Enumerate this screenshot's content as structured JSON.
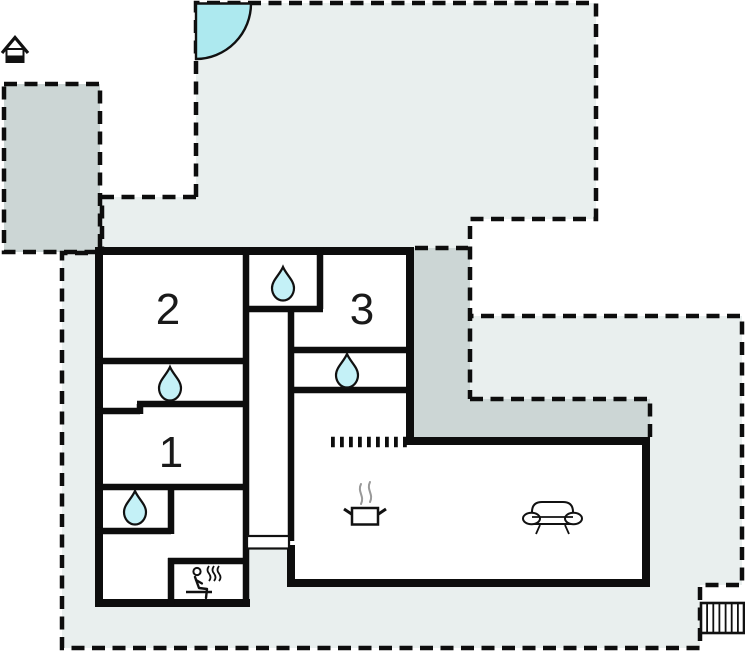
{
  "plan": {
    "type": "holiday-home-floor-plan",
    "rooms": [
      {
        "id": "room-2",
        "label": "2"
      },
      {
        "id": "room-3",
        "label": "3"
      },
      {
        "id": "room-1",
        "label": "1"
      }
    ],
    "icons": [
      {
        "name": "house-icon",
        "meaning": "house / orientation marker"
      },
      {
        "name": "door-swing-icon",
        "meaning": "quarter-circle swing at plot entrance"
      },
      {
        "name": "water-drop-icon",
        "meaning": "water / bathroom",
        "count": 4
      },
      {
        "name": "sauna-icon",
        "meaning": "sauna"
      },
      {
        "name": "stove-icon",
        "meaning": "kitchen stove"
      },
      {
        "name": "sofa-icon",
        "meaning": "living room sofa"
      },
      {
        "name": "steps-grate-icon",
        "meaning": "outdoor steps / grate"
      }
    ],
    "colors": {
      "plot": "#e9efee",
      "terrace": "#ccd6d5",
      "water": "#c4f1f7",
      "pool": "#ade9ef",
      "wall": "#0d0d0d",
      "background": "#ffffff"
    }
  }
}
